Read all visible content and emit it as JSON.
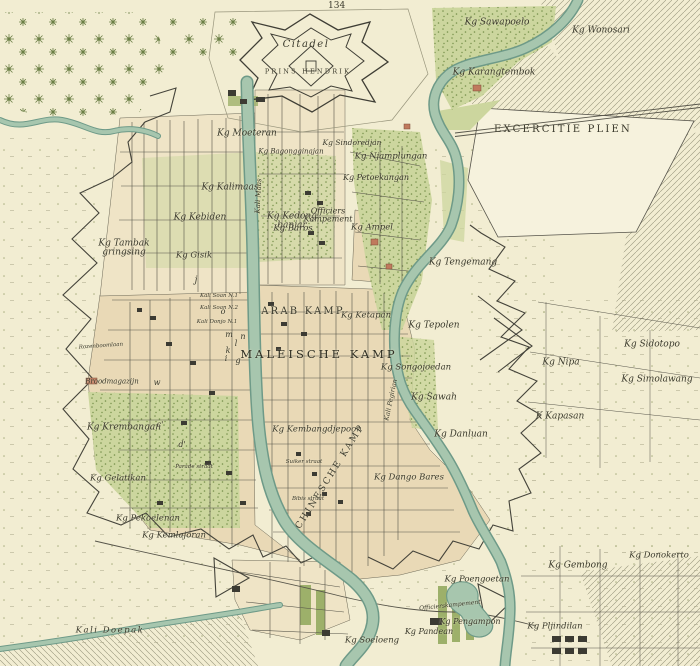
{
  "map": {
    "sheet_number": "134",
    "colors": {
      "paper": "#f2edd2",
      "paper_light": "#f6f2dd",
      "block_tan": "#e9d9b6",
      "block_tan_light": "#efe4c6",
      "vegetation_green": "#ccd69e",
      "vegetation_dot": "#76904a",
      "water_fill": "#a7c6ae",
      "water_edge": "#6e9a88",
      "ink_line": "#4b4a3e",
      "faint_line": "#98957c",
      "brick_red": "#c07a5d",
      "building_dark": "#3c3b33"
    },
    "labels": [
      {
        "text": "Citadel",
        "x": 306,
        "y": 45,
        "size": 10,
        "cls": "ital sp1"
      },
      {
        "text": "PRINS HENDRIK",
        "x": 308,
        "y": 72,
        "size": 6.5,
        "cls": "caps"
      },
      {
        "text": "Kg Sawapoelo",
        "x": 497,
        "y": 23,
        "size": 9,
        "cls": "ital"
      },
      {
        "text": "Kg Wonosari",
        "x": 601,
        "y": 31,
        "size": 9,
        "cls": "ital"
      },
      {
        "text": "Kg Karangtembok",
        "x": 494,
        "y": 73,
        "size": 9,
        "cls": "ital"
      },
      {
        "text": "EXCERCITIE PLIEN",
        "x": 563,
        "y": 130,
        "size": 10,
        "cls": "caps"
      },
      {
        "text": "Kg Moeteran",
        "x": 247,
        "y": 134,
        "size": 9,
        "cls": "ital"
      },
      {
        "text": "Kg Bagongginajan",
        "x": 291,
        "y": 152,
        "size": 7,
        "cls": "ital"
      },
      {
        "text": "Kg Sindoredjan",
        "x": 352,
        "y": 143,
        "size": 7.5,
        "cls": "ital"
      },
      {
        "text": "Kg Njamplungan",
        "x": 391,
        "y": 157,
        "size": 8.5,
        "cls": "ital"
      },
      {
        "text": "Kg Petoekangan",
        "x": 376,
        "y": 178,
        "size": 8,
        "cls": "ital"
      },
      {
        "text": "Kg Kalimaas",
        "x": 230,
        "y": 188,
        "size": 9,
        "cls": "ital"
      },
      {
        "text": "Kg Kedong|banjar",
        "x": 292,
        "y": 222,
        "size": 9,
        "cls": "ital"
      },
      {
        "text": "Officiers|Kampement",
        "x": 328,
        "y": 216,
        "size": 8,
        "cls": "ital"
      },
      {
        "text": "Kg Kebiden",
        "x": 200,
        "y": 218,
        "size": 9,
        "cls": "ital"
      },
      {
        "text": "Kg Tambak|gringsing",
        "x": 124,
        "y": 249,
        "size": 9,
        "cls": "ital"
      },
      {
        "text": "Kg Gisik",
        "x": 194,
        "y": 256,
        "size": 8.5,
        "cls": "ital"
      },
      {
        "text": "Kg Baros",
        "x": 293,
        "y": 229,
        "size": 8.5,
        "cls": "ital"
      },
      {
        "text": "Kg Ampel",
        "x": 372,
        "y": 228,
        "size": 8.5,
        "cls": "ital"
      },
      {
        "text": "Kg Tengemang",
        "x": 463,
        "y": 263,
        "size": 9,
        "cls": "ital"
      },
      {
        "text": "Kali Maas",
        "x": 259,
        "y": 196,
        "size": 7,
        "rot": -87,
        "cls": "ital"
      },
      {
        "text": "Kali Pegirian",
        "x": 391,
        "y": 400,
        "size": 6.5,
        "rot": -78,
        "cls": "ital"
      },
      {
        "text": "ARAB KAMP",
        "x": 303,
        "y": 312,
        "size": 10,
        "cls": "caps"
      },
      {
        "text": "Kg Ketapan",
        "x": 366,
        "y": 316,
        "size": 8.5,
        "cls": "ital"
      },
      {
        "text": "Kg Tepolen",
        "x": 434,
        "y": 326,
        "size": 9,
        "cls": "ital"
      },
      {
        "text": "MALEISCHE KAMP",
        "x": 319,
        "y": 355,
        "size": 11.5,
        "cls": "capsbig"
      },
      {
        "text": "Kg Songojoedan",
        "x": 416,
        "y": 368,
        "size": 8.5,
        "cls": "ital"
      },
      {
        "text": "Kg Nipa",
        "x": 561,
        "y": 363,
        "size": 9,
        "cls": "ital"
      },
      {
        "text": "Kg Sidotopo",
        "x": 652,
        "y": 345,
        "size": 9,
        "cls": "ital"
      },
      {
        "text": "Kg Simolawang",
        "x": 657,
        "y": 380,
        "size": 9,
        "cls": "ital"
      },
      {
        "text": "K Kapasan",
        "x": 560,
        "y": 417,
        "size": 9,
        "cls": "ital"
      },
      {
        "text": "Kg Sawah",
        "x": 434,
        "y": 398,
        "size": 9,
        "cls": "ital"
      },
      {
        "text": "Broodmagazijn",
        "x": 112,
        "y": 382,
        "size": 7,
        "cls": "ital"
      },
      {
        "text": "Kg Krembangan",
        "x": 124,
        "y": 428,
        "size": 9,
        "cls": "ital"
      },
      {
        "text": "Rozenboomlaan",
        "x": 101,
        "y": 347,
        "size": 5.5,
        "rot": -4,
        "cls": "ital"
      },
      {
        "text": "Kali Soan N.1",
        "x": 219,
        "y": 297,
        "size": 5.5,
        "cls": "ital"
      },
      {
        "text": "Kali Soan N.2",
        "x": 219,
        "y": 309,
        "size": 5.5,
        "cls": "ital"
      },
      {
        "text": "Kali Donjo N.1",
        "x": 217,
        "y": 323,
        "size": 5.5,
        "cls": "ital"
      },
      {
        "text": "Kg Kembangdjepoon",
        "x": 317,
        "y": 430,
        "size": 8.5,
        "cls": "ital"
      },
      {
        "text": "Kg Danluan",
        "x": 461,
        "y": 435,
        "size": 9,
        "cls": "ital"
      },
      {
        "text": "CHINESCHE KAMP",
        "x": 331,
        "y": 477,
        "size": 9,
        "rot": -58,
        "cls": "caps"
      },
      {
        "text": "Kg Dango Bares",
        "x": 409,
        "y": 478,
        "size": 8.5,
        "cls": "ital"
      },
      {
        "text": "Suiker straat",
        "x": 304,
        "y": 463,
        "size": 5.5,
        "cls": "ital"
      },
      {
        "text": "Bibis straat",
        "x": 308,
        "y": 500,
        "size": 5.5,
        "cls": "ital"
      },
      {
        "text": "Parade straat",
        "x": 194,
        "y": 468,
        "size": 5.5,
        "cls": "ital"
      },
      {
        "text": "Kg Gelatikan",
        "x": 118,
        "y": 479,
        "size": 8.5,
        "cls": "ital"
      },
      {
        "text": "Kg Pekoelenan",
        "x": 148,
        "y": 519,
        "size": 8.5,
        "cls": "ital"
      },
      {
        "text": "Kg Kemlajoran",
        "x": 174,
        "y": 536,
        "size": 8.5,
        "cls": "ital"
      },
      {
        "text": "Kali Doepak",
        "x": 110,
        "y": 631,
        "size": 8.5,
        "cls": "ital sp1"
      },
      {
        "text": "Kg Soeloeng",
        "x": 372,
        "y": 641,
        "size": 8.5,
        "cls": "ital"
      },
      {
        "text": "Kg Poengoetan",
        "x": 477,
        "y": 580,
        "size": 8.5,
        "cls": "ital"
      },
      {
        "text": "Officierskampement",
        "x": 450,
        "y": 606,
        "size": 6,
        "rot": -6,
        "cls": "ital"
      },
      {
        "text": "Kg Pengampon",
        "x": 470,
        "y": 622,
        "size": 8,
        "cls": "ital"
      },
      {
        "text": "Kg Pandean",
        "x": 429,
        "y": 632,
        "size": 8,
        "cls": "ital"
      },
      {
        "text": "Kg Pljindilan",
        "x": 555,
        "y": 627,
        "size": 8.5,
        "cls": "ital"
      },
      {
        "text": "Kg Gembong",
        "x": 578,
        "y": 566,
        "size": 9,
        "cls": "ital"
      },
      {
        "text": "Kg Donokerto",
        "x": 659,
        "y": 556,
        "size": 8.5,
        "cls": "ital"
      },
      {
        "text": "o",
        "x": 223,
        "y": 312,
        "size": 8,
        "cls": "ital"
      },
      {
        "text": "m",
        "x": 229,
        "y": 335,
        "size": 8,
        "cls": "ital"
      },
      {
        "text": "n",
        "x": 243,
        "y": 337,
        "size": 8,
        "cls": "ital"
      },
      {
        "text": "l",
        "x": 236,
        "y": 344,
        "size": 8,
        "cls": "ital"
      },
      {
        "text": "k",
        "x": 228,
        "y": 351,
        "size": 8,
        "cls": "ital"
      },
      {
        "text": "i",
        "x": 226,
        "y": 359,
        "size": 8,
        "cls": "ital"
      },
      {
        "text": "g",
        "x": 238,
        "y": 361,
        "size": 8,
        "cls": "ital"
      },
      {
        "text": "w",
        "x": 157,
        "y": 383,
        "size": 8,
        "cls": "ital"
      },
      {
        "text": "j",
        "x": 196,
        "y": 281,
        "size": 9,
        "cls": "ital"
      },
      {
        "text": "c'",
        "x": 160,
        "y": 425,
        "size": 8,
        "cls": "ital"
      },
      {
        "text": "d'",
        "x": 182,
        "y": 445,
        "size": 8,
        "cls": "ital"
      }
    ]
  }
}
